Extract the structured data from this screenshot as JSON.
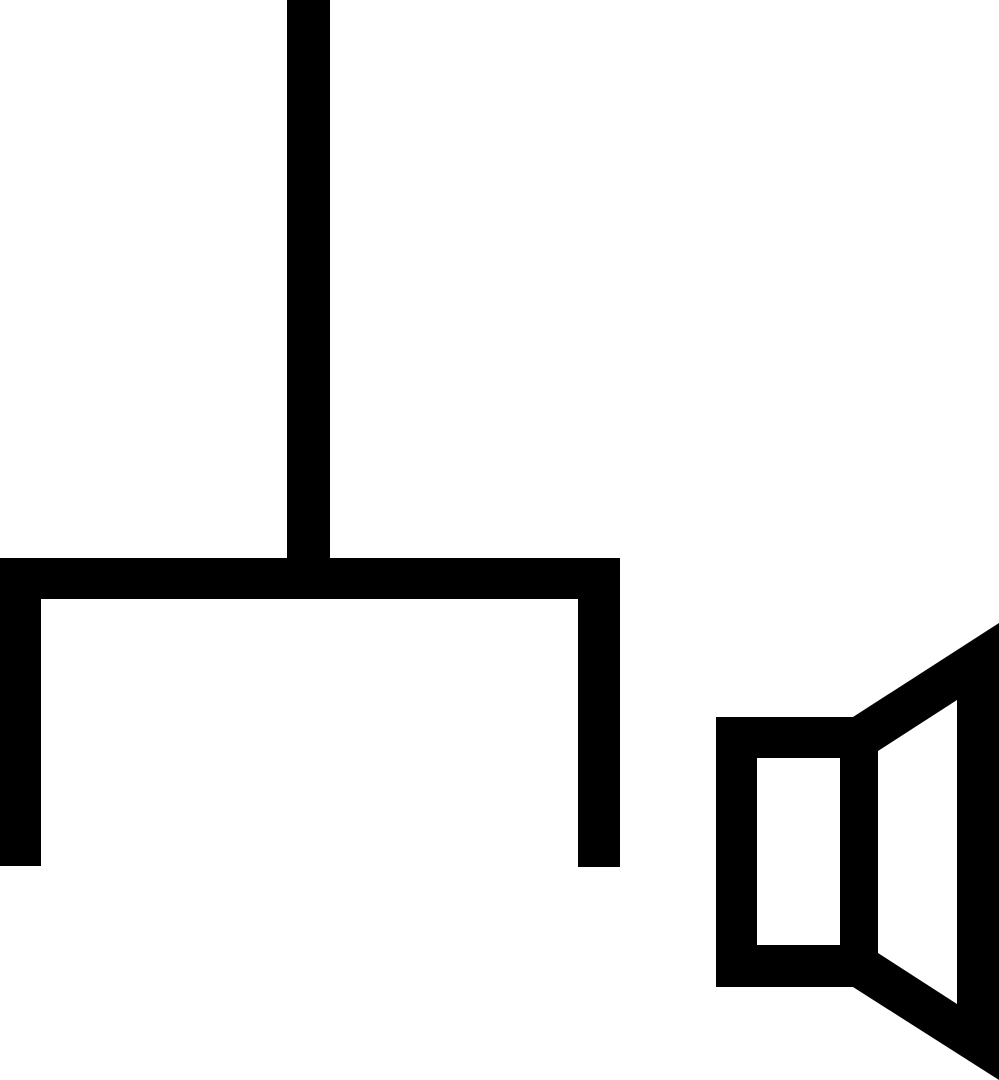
{
  "canvas": {
    "width": 999,
    "height": 1080,
    "background": "#ffffff",
    "ink": "#000000"
  },
  "icons": {
    "bracket": {
      "label": "bracket-with-stem-icon",
      "shapes": {
        "stem": "287,0 330,0 330,599 287,599",
        "top_bar": "0,558 620,558 620,599 0,599",
        "left_leg": "0,558 41,558 41,866 0,866",
        "right_leg": "578,558 620,558 620,867 578,867"
      }
    },
    "speaker": {
      "label": "horn-loudspeaker-icon",
      "shapes": {
        "box_outer": "716,717 878,717 878,987 716,987",
        "box_inner": "757,758 840,758 840,945 757,945",
        "horn_outer": "853,717 999,623 999,1080 853,987",
        "horn_inner": "878,751 957,700 957,1004 878,953"
      }
    }
  }
}
